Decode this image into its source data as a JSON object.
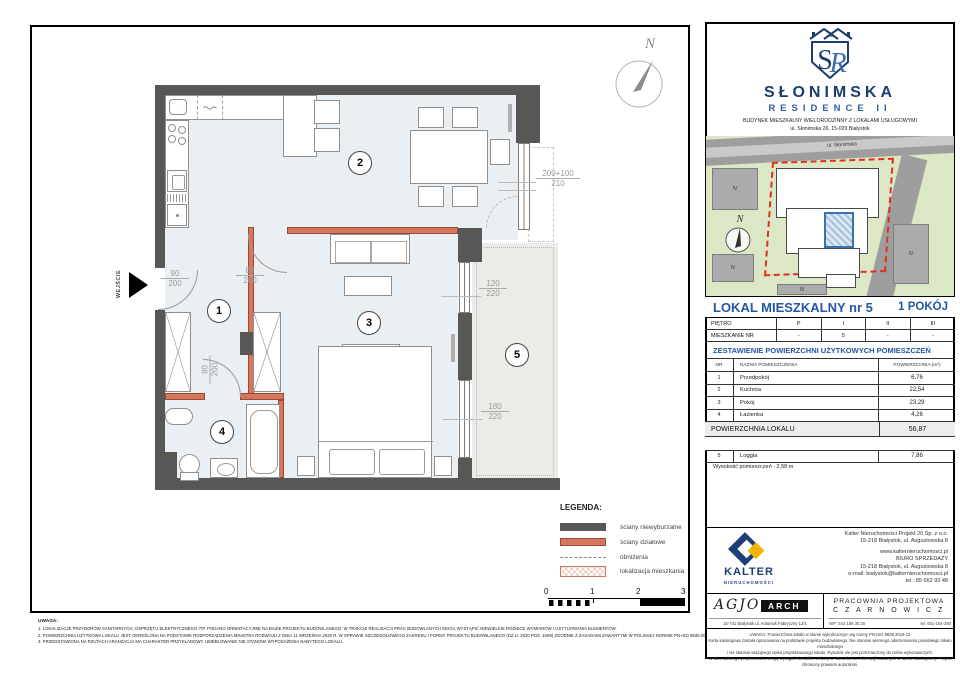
{
  "colors": {
    "heading_blue": "#2456a4",
    "brand_navy": "#1c3d6d",
    "wall_dark": "#575756",
    "wall_partition": "#d4775e",
    "floor_blue": "#e9eff3",
    "loggia_gray": "#edebe7",
    "site_green": "#dce7c6",
    "site_red": "#e0301e",
    "unit_highlight": "#3a72b0",
    "kalter_navy": "#1e3e78",
    "kalter_yellow": "#f2b400"
  },
  "plan": {
    "entrance": "WEJŚCIE",
    "compass": "N",
    "markers": [
      "1",
      "2",
      "3",
      "4",
      "5"
    ],
    "dims": {
      "entry": {
        "top": "90",
        "bottom": "200"
      },
      "living_door": {
        "top": "80",
        "bottom": "200"
      },
      "bath_door": {
        "top": "80",
        "bottom": "200"
      },
      "window_main": {
        "top": "200+100",
        "bottom": "210"
      },
      "window_small": {
        "top": "120",
        "bottom": "220"
      },
      "window_large": {
        "top": "180",
        "bottom": "220"
      }
    },
    "legend": {
      "title": "LEGENDA:",
      "items": [
        {
          "label": "ściany niewyburzalne"
        },
        {
          "label": "ściany działowe"
        },
        {
          "label": "obniżenia"
        },
        {
          "label": "lokalizacja mieszkania"
        }
      ]
    },
    "scalebar": [
      "0",
      "1",
      "2",
      "3"
    ],
    "notes": {
      "title": "UWAGA:",
      "lines": [
        "1.    LOKALIZACJE PRZYBORÓW SANITARNYCH, OSPRZĘTU ELEKTRYCZNEGO ITP. PODANO ORIENTACYJNIE NA BAZIE PROJEKTU BUDOWLANEGO. W TRAKCIE REALIZACJI PRAC BUDOWLANYCH MOGĄ WYSTĄPIĆ NIEWIELKIE RÓŻNICE WYMIARÓW I USYTUOWANIA ELEMENTÓW.",
        "2.    POWIERZCHNIA UŻYTKOWA LOKALU JEST OKREŚLONA NA PODSTAWIE ROZPORZĄDZENIA MINISTRA ROZWOJU Z DNIA 11 WRZEŚNIA 2020 R. W SPRAWIE SZCZEGÓŁOWEGO ZAKRESU I FORMY PROJEKTU BUDOWLANEGO (DZ.U. 2020 POZ. 1609) ZGODNIE Z ZASADAMI ZAWARTYMI W POLSKIEJ NORMIE PN-ISO 9836:2015-12.",
        "3.    PRZEDSTAWIONA NA RZUTACH ARANŻACJA MA CHARAKTER PRZYKŁADOWY. UMEBLOWANIE NIE STANOWI WYPOSAŻENIA NABYTEGO LOKALU."
      ]
    }
  },
  "panel": {
    "brand": {
      "monogram_s": "S",
      "monogram_r": "R",
      "roman": "II",
      "name": "SŁONIMSKA",
      "line2": "RESIDENCE II",
      "desc": "BUDYNEK MIESZKALNY WIELORODZINNY Z LOKALAMI USŁUGOWYMI",
      "address": "ul. Słonimska 26, 15-029 Białystok"
    },
    "siteplan": {
      "street": "ul. Słonimska",
      "compass": "N",
      "floor_tags": [
        "IV",
        "IV",
        "IV",
        "IV"
      ]
    },
    "title": {
      "left": "LOKAL MIESZKALNY  nr 5",
      "right": "1 POKÓJ"
    },
    "floors": {
      "label1": "PIĘTRO",
      "cols1": [
        "P",
        "I",
        "II",
        "III"
      ],
      "label2": "MIESZKANIE NR",
      "cols2": [
        "-",
        "5",
        "-",
        "-"
      ]
    },
    "area_heading": "ZESTAWIENIE POWIERZCHNI UŻYTKOWYCH POMIESZCZEŃ",
    "table": {
      "h_nr": "NR",
      "h_name": "NAZWA POMIESZCZENIA",
      "h_area": "POWIERZCHNIA (m²)",
      "rows": [
        {
          "nr": "1",
          "name": "Przedpokój",
          "area": "6,76"
        },
        {
          "nr": "2",
          "name": "Kuchnia",
          "area": "22,54"
        },
        {
          "nr": "3",
          "name": "Pokój",
          "area": "23,29"
        },
        {
          "nr": "4",
          "name": "Łazienka",
          "area": "4,26"
        }
      ],
      "total_label": "POWIERZCHNIA LOKALU",
      "total_value": "56,87",
      "loggia": {
        "nr": "5",
        "name": "Loggia",
        "area": "7,86"
      },
      "height_note": "Wysokość pomieszczeń - 2,58 m"
    },
    "kalter": {
      "name": "KALTER",
      "sub": "NIERUCHOMOŚCI",
      "lines": [
        "Kalter Nieruchomości Projekt 20  Sp. z o.o.",
        "15-218 Białystok, ul. Augustowska 8",
        "www.kalternieruchomosci.pl",
        "BIURO SPRZEDAŻY",
        "15-218 Białystok, ul. Augustowska 8",
        "e-mail: bialystok@kalternieruchomosci.pl",
        "tel.: 85 662 93 48"
      ]
    },
    "designers": {
      "agio": "AGJO",
      "arch": "ARCH",
      "agio_address": "15-741 Białystok    ul. Antoniuk Fabryczny  12/1",
      "studio1": "PRACOWNIA PROJEKTOWA",
      "studio2": "C Z A R N O W I C Z",
      "nip": "NIP:  542 186 35 28",
      "tel": "tel. 601-154-380"
    },
    "footnote": [
      "UWAGA:   Powierzchnia lokalu w stanie wykończonym wg normy PN-ISO 9836:2015-12",
      "Karta katalogowa została opracowana na podstawie projektu budowlanego. Nie stanowi wiernego odwzorowania powstałego lokalu mieszkalnego",
      "i nie stanowi wiążącego opisu projektowanego lokalu. Rysunek nie jest przeznaczony do celów wykonawczych.",
      "W toku dalszego projektowania mogą wystąpić niewielkie zmiany w stosunku do informacji zawartych w karcie katalogowej. Projekt chroniony prawami autorskimi."
    ]
  }
}
